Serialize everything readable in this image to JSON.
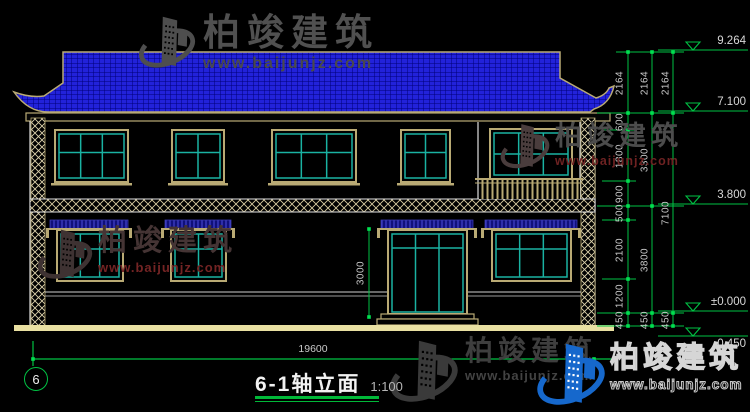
{
  "title_block": {
    "title": "6-1轴立面",
    "scale": "1:100"
  },
  "axis": {
    "number": "6"
  },
  "dims": {
    "overall_width": "19600",
    "door_height": "3000"
  },
  "elevations": [
    "9.264",
    "7.100",
    "3.800",
    "±0.000",
    "-0.450"
  ],
  "dim_chains": {
    "inner": [
      "2164",
      "600",
      "1800",
      "900",
      "500",
      "2100",
      "1200",
      "450"
    ],
    "middle": [
      "2164",
      "3300",
      "3800",
      "450"
    ],
    "outer": [
      "2164",
      "7100",
      "450"
    ]
  },
  "watermark": {
    "brand": "柏竣建筑",
    "url": "www.baijunjz.com"
  },
  "colors": {
    "roof_blue": "#2222da",
    "roof_grid": "#000078",
    "awning_navy": "#10107a",
    "awning_hatch": "#4646d2",
    "frame_teal": "#1ab2a2",
    "trim_tan": "#b9aa74",
    "line_white": "#dedede",
    "dim_green": "#00c244",
    "ground_yellow": "#e9e0a2",
    "logo_blue": "#1668cc"
  }
}
